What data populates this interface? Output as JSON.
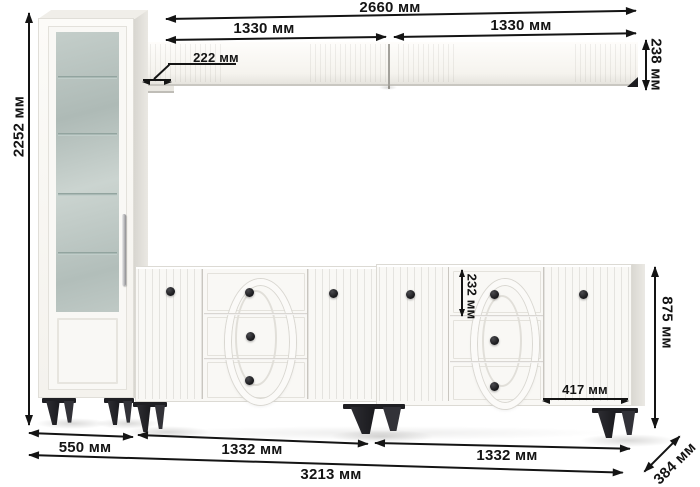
{
  "diagram": {
    "type": "furniture-dimension-diagram",
    "unit": "мм",
    "labels": {
      "total_height": "2252 мм",
      "shelf_total_width": "2660 мм",
      "shelf_segment_left": "1330 мм",
      "shelf_segment_right": "1330 мм",
      "shelf_depth": "222 мм",
      "shelf_height": "238 мм",
      "top_drawer_height": "232 мм",
      "right_door_width": "417 мм",
      "sideboard_height": "875 мм",
      "cabinet_width": "550 мм",
      "sideboard_left_width": "1332 мм",
      "sideboard_right_width": "1332 мм",
      "total_width": "3213 мм",
      "unit_depth": "384 мм"
    },
    "colors": {
      "background": "#ffffff",
      "dimension_ink": "#141414",
      "furniture_white": "#f9f8f5",
      "furniture_shade": "#e3e1db",
      "glass_tint": "#b7c2be",
      "leg_black": "#232327",
      "knob_black": "#17171a"
    },
    "parts": [
      {
        "name": "display-cabinet",
        "doors": 1,
        "glass_shelves": 4,
        "legs": 2
      },
      {
        "name": "wall-shelf",
        "segments": 2
      },
      {
        "name": "sideboard-left",
        "doors": 2,
        "drawers": 3
      },
      {
        "name": "sideboard-right",
        "doors": 2,
        "drawers": 3
      }
    ]
  }
}
